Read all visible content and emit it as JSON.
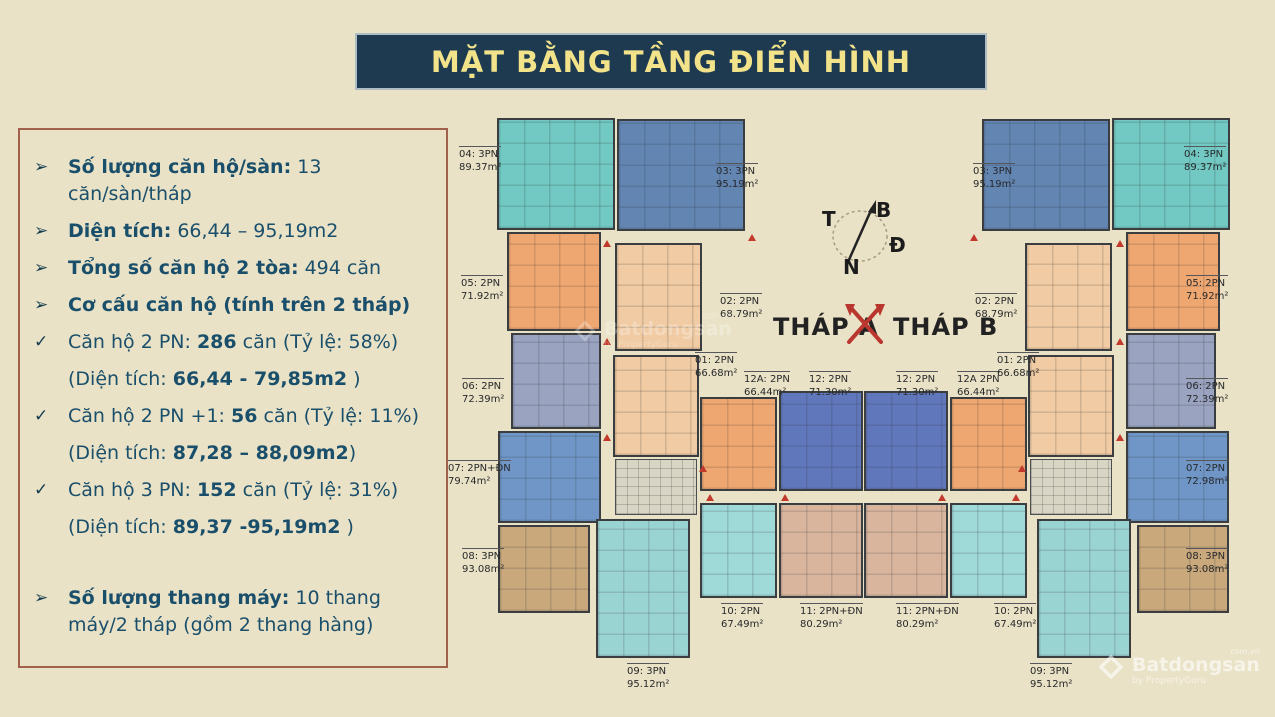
{
  "title": "MẶT BẰNG TẦNG ĐIỂN HÌNH",
  "palette": {
    "background": "#eae2c6",
    "banner_bg": "#1d3a50",
    "banner_text": "#f2e38a",
    "panel_border": "#a3604c",
    "panel_text": "#1a4f6b",
    "wall": "#3a3e40",
    "marker_red": "#c0392b",
    "unit_teal": "#72c8c2",
    "unit_orange": "#efa771",
    "unit_slate": "#9aa3c0",
    "unit_blue": "#6f96c6",
    "unit_tan": "#c9a87c",
    "unit_dkblue": "#6285b2",
    "unit_salmon": "#f1cba3",
    "unit_ltteal": "#9ad4d2",
    "unit_indigo": "#6177bb",
    "unit_cyan": "#9fd9d8",
    "unit_tanpink": "#d9b59d",
    "unit_lobby": "#d9d5c5"
  },
  "info_panel": {
    "items": [
      {
        "bullet": "➢",
        "s1": "Số lượng căn hộ/sàn:",
        "s2": " 13 căn/sàn/tháp",
        "s3": ""
      },
      {
        "bullet": "➢",
        "s1": "Diện tích:",
        "s2": " 66,44 – 95,19m2",
        "s3": ""
      },
      {
        "bullet": "➢",
        "s1": "Tổng số căn hộ 2 tòa:",
        "s2": " 494 căn",
        "s3": ""
      },
      {
        "bullet": "➢",
        "s1": "Cơ cấu căn hộ (tính trên 2 tháp)",
        "s2": "",
        "s3": ""
      },
      {
        "bullet": "✓",
        "s1": "Căn hộ 2 PN: ",
        "s2": "286",
        "s3": " căn (Tỷ lệ: 58%)"
      },
      {
        "bullet": "",
        "s1": "(Diện tích: ",
        "s2": "66,44 - 79,85m2",
        "s3": " )"
      },
      {
        "bullet": "✓",
        "s1": "Căn hộ 2 PN +1: ",
        "s2": "56",
        "s3": " căn (Tỷ lệ: 11%)"
      },
      {
        "bullet": "",
        "s1": "(Diện tích: ",
        "s2": "87,28 – 88,09m2",
        "s3": ")"
      },
      {
        "bullet": "✓",
        "s1": "Căn hộ 3 PN: ",
        "s2": "152",
        "s3": " căn (Tỷ lệ: 31%)"
      },
      {
        "bullet": "",
        "s1": "(Diện tích: ",
        "s2": "89,37 -95,19m2",
        "s3": " )"
      },
      {
        "bullet": "➢",
        "s1": "Số lượng thang máy:",
        "s2": " 10 thang máy/2 tháp (gồm 2 thang hàng)",
        "s3": ""
      }
    ]
  },
  "plan": {
    "tower_a": "THÁP A",
    "tower_b": "THÁP B",
    "compass": {
      "north": "B",
      "east": "Đ",
      "south": "N",
      "west": "T"
    },
    "labels": {
      "a04": {
        "l1": "04: 3PN",
        "l2": "89.37m²"
      },
      "a05": {
        "l1": "05: 2PN",
        "l2": "71.92m²"
      },
      "a06": {
        "l1": "06: 2PN",
        "l2": "72.39m²"
      },
      "a07": {
        "l1": "07: 2PN+ĐN",
        "l2": "79.74m²"
      },
      "a08": {
        "l1": "08: 3PN",
        "l2": "93.08m²"
      },
      "a03": {
        "l1": "03: 3PN",
        "l2": "95.19m²"
      },
      "a02": {
        "l1": "02: 2PN",
        "l2": "68.79m²"
      },
      "a01": {
        "l1": "01: 2PN",
        "l2": "66.68m²"
      },
      "a12A": {
        "l1": "12A: 2PN",
        "l2": "66.44m²"
      },
      "a12": {
        "l1": "12: 2PN",
        "l2": "71.30m²"
      },
      "a10": {
        "l1": "10: 2PN",
        "l2": "67.49m²"
      },
      "a11": {
        "l1": "11: 2PN+ĐN",
        "l2": "80.29m²"
      },
      "a09": {
        "l1": "09: 3PN",
        "l2": "95.12m²"
      },
      "b12": {
        "l1": "12: 2PN",
        "l2": "71.30m²"
      },
      "b12A": {
        "l1": "12A 2PN",
        "l2": "66.44m²"
      },
      "b01": {
        "l1": "01: 2PN",
        "l2": "66.68m²"
      },
      "b02": {
        "l1": "02: 2PN",
        "l2": "68.79m²"
      },
      "b03": {
        "l1": "03: 3PN",
        "l2": "95.19m²"
      },
      "b11": {
        "l1": "11: 2PN+ĐN",
        "l2": "80.29m²"
      },
      "b10": {
        "l1": "10: 2PN",
        "l2": "67.49m²"
      },
      "b09": {
        "l1": "09: 3PN",
        "l2": "95.12m²"
      },
      "b04": {
        "l1": "04: 3PN",
        "l2": "89.37m²"
      },
      "b05": {
        "l1": "05: 2PN",
        "l2": "71.92m²"
      },
      "b06": {
        "l1": "06: 2PN",
        "l2": "72.39m²"
      },
      "b07": {
        "l1": "07: 2PN",
        "l2": "72.98m²"
      },
      "b08": {
        "l1": "08: 3PN",
        "l2": "93.08m²"
      }
    }
  },
  "watermark": {
    "brand": "Batdongsan",
    "domain": "com.vn",
    "byline": "by PropertyGuru"
  }
}
